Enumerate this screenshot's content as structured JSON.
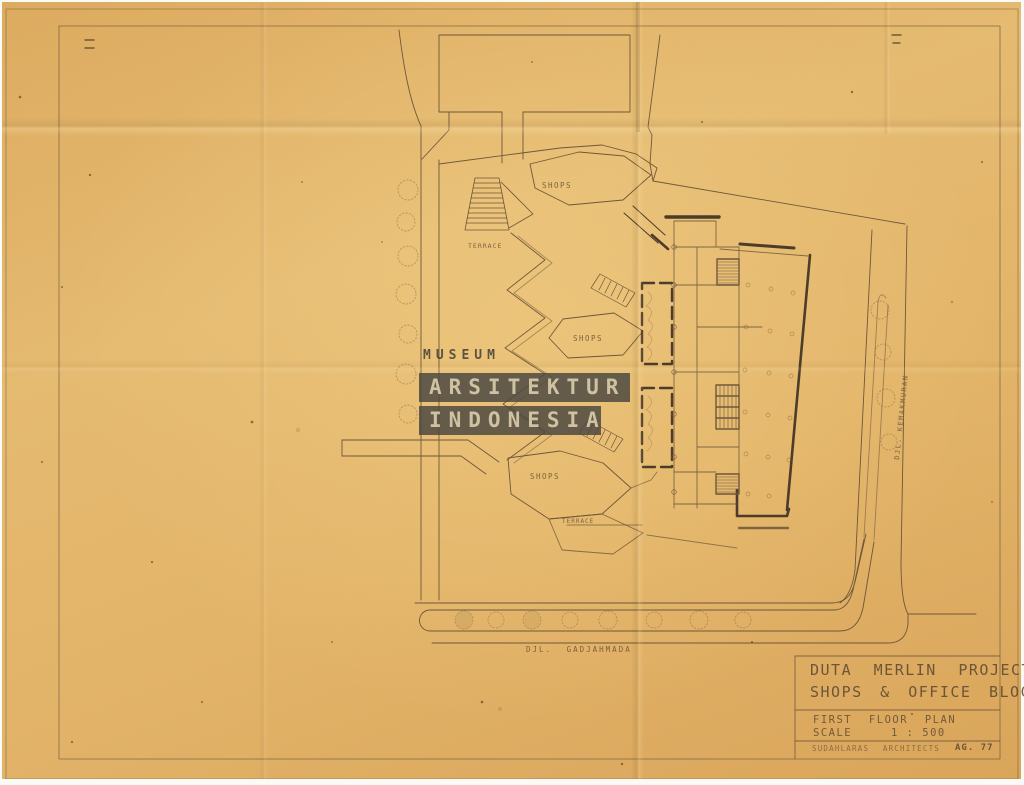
{
  "meta": {
    "description": "Scanned architectural site/floor-plan drawing on aged tracing paper"
  },
  "watermark": {
    "museum": "MUSEUM",
    "line1": "ARSITEKTUR",
    "line2": "INDONESIA"
  },
  "plan": {
    "labels": {
      "shops_top": "SHOPS",
      "terrace_top": "TERRACE",
      "shops_mid": "SHOPS",
      "shops_low": "SHOPS",
      "terrace_low": "TERRACE",
      "street_south": "DJL. GADJAHMADA",
      "street_east": "DJL. KEMAKMURAN"
    }
  },
  "title_block": {
    "project_line1": "DUTA MERLIN PROJECT",
    "project_line2": "SHOPS & OFFICE BLOCK",
    "drawing_title": "FIRST FLOOR PLAN",
    "scale_label": "SCALE",
    "scale_value": "1 : 500",
    "firm": "SUDAHLARAS ARCHITECTS",
    "sheet_no": "AG. 77"
  },
  "colors": {
    "paper": "#e2b469",
    "ink": "#6f573a",
    "ink_bold": "#4c3c2a",
    "watermark_bar": "#55504a",
    "watermark_text": "#cfc2a2"
  }
}
